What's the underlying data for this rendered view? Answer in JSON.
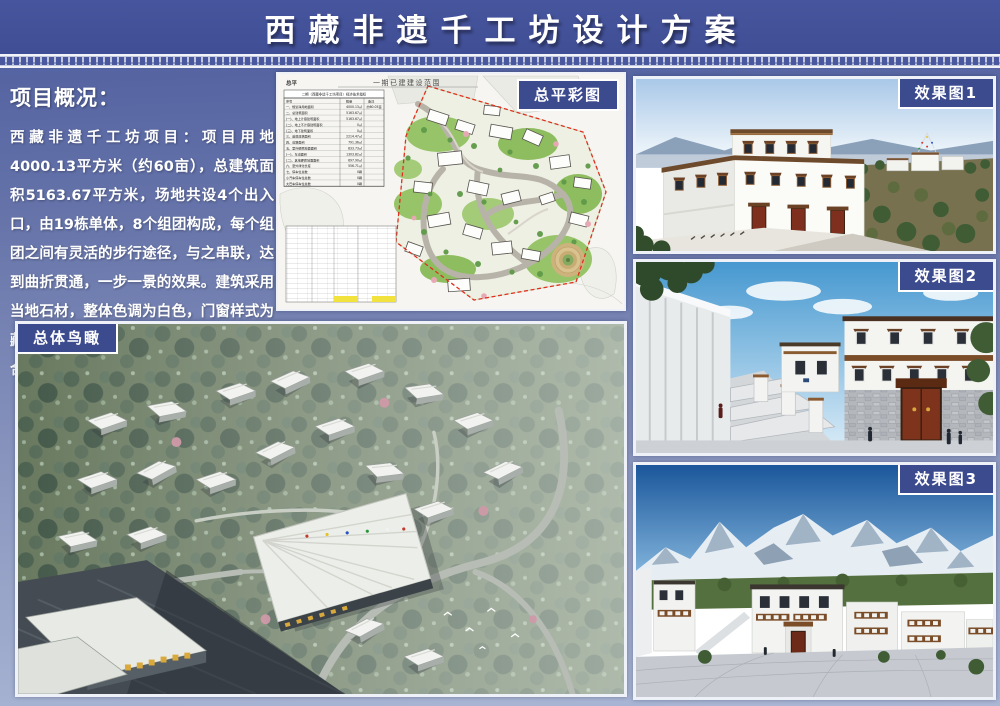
{
  "poster": {
    "title": "西藏非遗千工坊设计方案"
  },
  "overview": {
    "heading": "项目概况：",
    "body": "西藏非遗千工坊项目：项目用地4000.13平方米（约60亩），总建筑面积5163.67平方米，场地共设4个出入口，由19栋单体，8个组团构成，每个组团之间有灵活的步行途径，与之串联，达到曲折贯通，一步一景的效果。建筑采用当地石材，整体色调为白色，门窗样式为藏式传统样式，有着浓厚的藏式风味，符合片区的整体风貌。"
  },
  "panels": {
    "site_plan": {
      "label": "总平彩图",
      "corner_mark": "总平",
      "drawing_title": "一期已建建设范围",
      "table_title": "二期（西藏非遗千工坊项目）经济技术指标",
      "table_headers": [
        "序号",
        "数量",
        "备注"
      ],
      "table_rows": [
        [
          "一、规划净用地面积",
          "4000.13㎡",
          "约60.05亩"
        ],
        [
          "二、总建筑面积",
          "5163.67㎡",
          ""
        ],
        [
          "(一)、地上计容建筑面积",
          "5163.67㎡",
          ""
        ],
        [
          "(二)、地上不计容建筑面积",
          "0㎡",
          ""
        ],
        [
          "(三)、地下建筑面积",
          "0㎡",
          ""
        ],
        [
          "三、基底建筑面积",
          "2214.47㎡",
          ""
        ],
        [
          "四、道路面积",
          "791.36㎡",
          ""
        ],
        [
          "五、室外硬质地面面积",
          "833.73㎡",
          ""
        ],
        [
          "(一)、车道面积",
          "1303.82㎡",
          ""
        ],
        [
          "(二)、其他硬质地面面积",
          "697.90㎡",
          ""
        ],
        [
          "六、室外绿化长度",
          "556.71㎡",
          ""
        ],
        [
          "七、停车位总数",
          "0辆",
          ""
        ],
        [
          "小汽车停车位总数",
          "0辆",
          ""
        ],
        [
          "大巴车停车位总数",
          "0辆",
          ""
        ]
      ]
    },
    "aerial": {
      "label": "总体鸟瞰"
    },
    "render1": {
      "label": "效果图1"
    },
    "render2": {
      "label": "效果图2"
    },
    "render3": {
      "label": "效果图3"
    }
  },
  "colors": {
    "title_bar": "#44529b",
    "label_box": "#3c4a8e",
    "background_top": "#4d5c9e",
    "background_bottom": "#aab6d4",
    "boundary_red": "#e03020"
  }
}
